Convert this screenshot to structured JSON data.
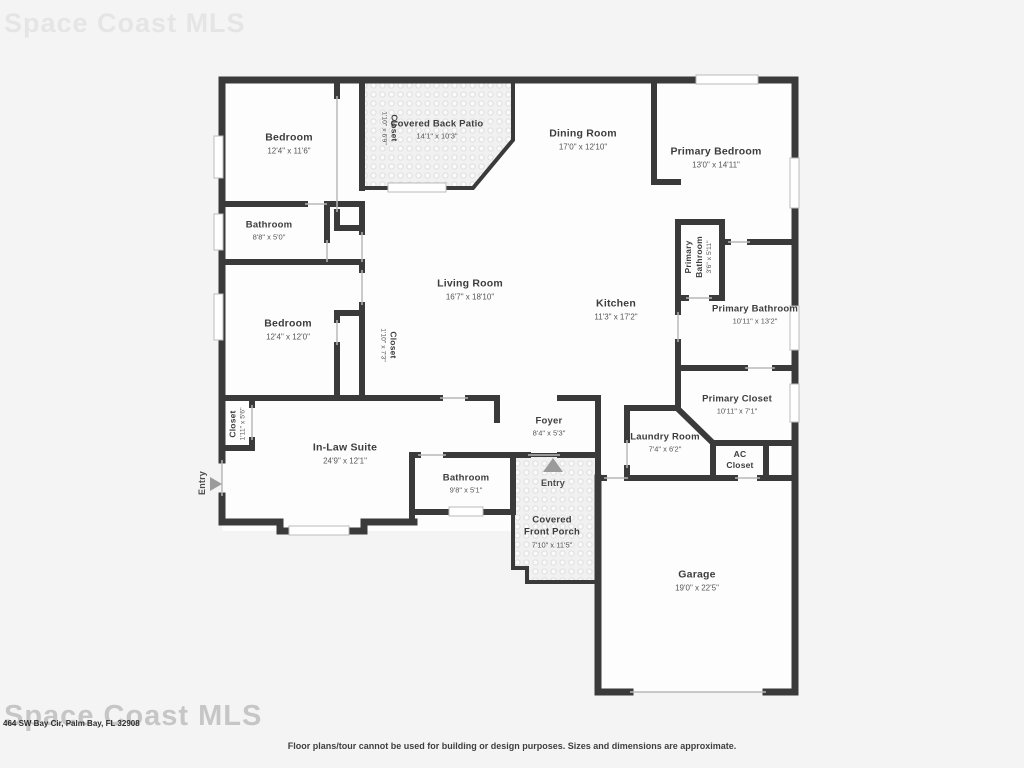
{
  "watermark": {
    "text": "Space Coast MLS"
  },
  "address_line": "464 SW Bay Cir, Palm Bay, FL 32908",
  "disclaimer": "Floor plans/tour cannot be used for building or design purposes. Sizes and dimensions are approximate.",
  "colors": {
    "wall": "#3a3a3a",
    "room_fill": "#fdfdfd",
    "page_bg": "#f4f4f4",
    "label_text": "#3d3d3d",
    "dims_text": "#555555",
    "arrow": "#9b9b9b",
    "window_line": "#bbbbbb"
  },
  "rooms": [
    {
      "id": "bedroom-1",
      "name": "Bedroom",
      "dims": "12'4\" x 11'6\"",
      "x": 289,
      "y": 144,
      "rot": 0,
      "cls": "lg"
    },
    {
      "id": "closet-1",
      "name": "Closet",
      "dims": "1'10\" x 6'9\"",
      "x": 389,
      "y": 128,
      "rot": 90,
      "cls": "sm"
    },
    {
      "id": "covered-back-patio",
      "name": "Covered Back Patio",
      "dims": "14'1\" x 10'3\"",
      "x": 437,
      "y": 130,
      "rot": 0,
      "cls": "md"
    },
    {
      "id": "dining-room",
      "name": "Dining Room",
      "dims": "17'0\" x 12'10\"",
      "x": 583,
      "y": 140,
      "rot": 0,
      "cls": "lg"
    },
    {
      "id": "primary-bedroom",
      "name": "Primary Bedroom",
      "dims": "13'0\" x 14'11\"",
      "x": 716,
      "y": 158,
      "rot": 0,
      "cls": "lg"
    },
    {
      "id": "bathroom-1",
      "name": "Bathroom",
      "dims": "8'8\" x 5'0\"",
      "x": 269,
      "y": 231,
      "rot": 0,
      "cls": "md"
    },
    {
      "id": "living-room",
      "name": "Living Room",
      "dims": "16'7\" x 18'10\"",
      "x": 470,
      "y": 290,
      "rot": 0,
      "cls": "lg"
    },
    {
      "id": "kitchen",
      "name": "Kitchen",
      "dims": "11'3\" x 17'2\"",
      "x": 616,
      "y": 310,
      "rot": 0,
      "cls": "lg"
    },
    {
      "id": "primary-bathroom-small",
      "name": "Primary\nBathroom",
      "dims": "3'6\" x 5'11\"",
      "x": 699,
      "y": 257,
      "rot": -90,
      "cls": "sm"
    },
    {
      "id": "primary-bathroom",
      "name": "Primary Bathroom",
      "dims": "10'11\" x 13'2\"",
      "x": 755,
      "y": 315,
      "rot": 0,
      "cls": "md"
    },
    {
      "id": "bedroom-2",
      "name": "Bedroom",
      "dims": "12'4\" x 12'0\"",
      "x": 288,
      "y": 330,
      "rot": 0,
      "cls": "lg"
    },
    {
      "id": "closet-2",
      "name": "Closet",
      "dims": "1'10\" x 7'3\"",
      "x": 388,
      "y": 345,
      "rot": 90,
      "cls": "sm"
    },
    {
      "id": "primary-closet",
      "name": "Primary Closet",
      "dims": "10'11\" x 7'1\"",
      "x": 737,
      "y": 405,
      "rot": 0,
      "cls": "md"
    },
    {
      "id": "closet-3",
      "name": "Closet",
      "dims": "1'11\" x 5'6\"",
      "x": 238,
      "y": 424,
      "rot": -90,
      "cls": "sm"
    },
    {
      "id": "in-law-suite",
      "name": "In-Law Suite",
      "dims": "24'9\" x 12'1\"",
      "x": 345,
      "y": 454,
      "rot": 0,
      "cls": "lg"
    },
    {
      "id": "foyer",
      "name": "Foyer",
      "dims": "8'4\" x 5'3\"",
      "x": 549,
      "y": 427,
      "rot": 0,
      "cls": "md"
    },
    {
      "id": "laundry-room",
      "name": "Laundry Room",
      "dims": "7'4\" x 6'2\"",
      "x": 665,
      "y": 443,
      "rot": 0,
      "cls": "md"
    },
    {
      "id": "ac-closet",
      "name": "AC\nCloset",
      "dims": "",
      "x": 740,
      "y": 460,
      "rot": 0,
      "cls": "sm"
    },
    {
      "id": "bathroom-2",
      "name": "Bathroom",
      "dims": "9'8\" x 5'1\"",
      "x": 466,
      "y": 484,
      "rot": 0,
      "cls": "md"
    },
    {
      "id": "entry-left",
      "name": "Entry",
      "dims": "",
      "x": 203,
      "y": 483,
      "rot": -90,
      "cls": "entry"
    },
    {
      "id": "entry-front",
      "name": "Entry",
      "dims": "",
      "x": 553,
      "y": 484,
      "rot": 0,
      "cls": "entry"
    },
    {
      "id": "covered-front-porch",
      "name": "Covered\nFront Porch",
      "dims": "7'10\" x 11'5\"",
      "x": 552,
      "y": 532,
      "rot": 0,
      "cls": "md"
    },
    {
      "id": "garage",
      "name": "Garage",
      "dims": "19'0\" x 22'5\"",
      "x": 697,
      "y": 581,
      "rot": 0,
      "cls": "lg"
    }
  ]
}
